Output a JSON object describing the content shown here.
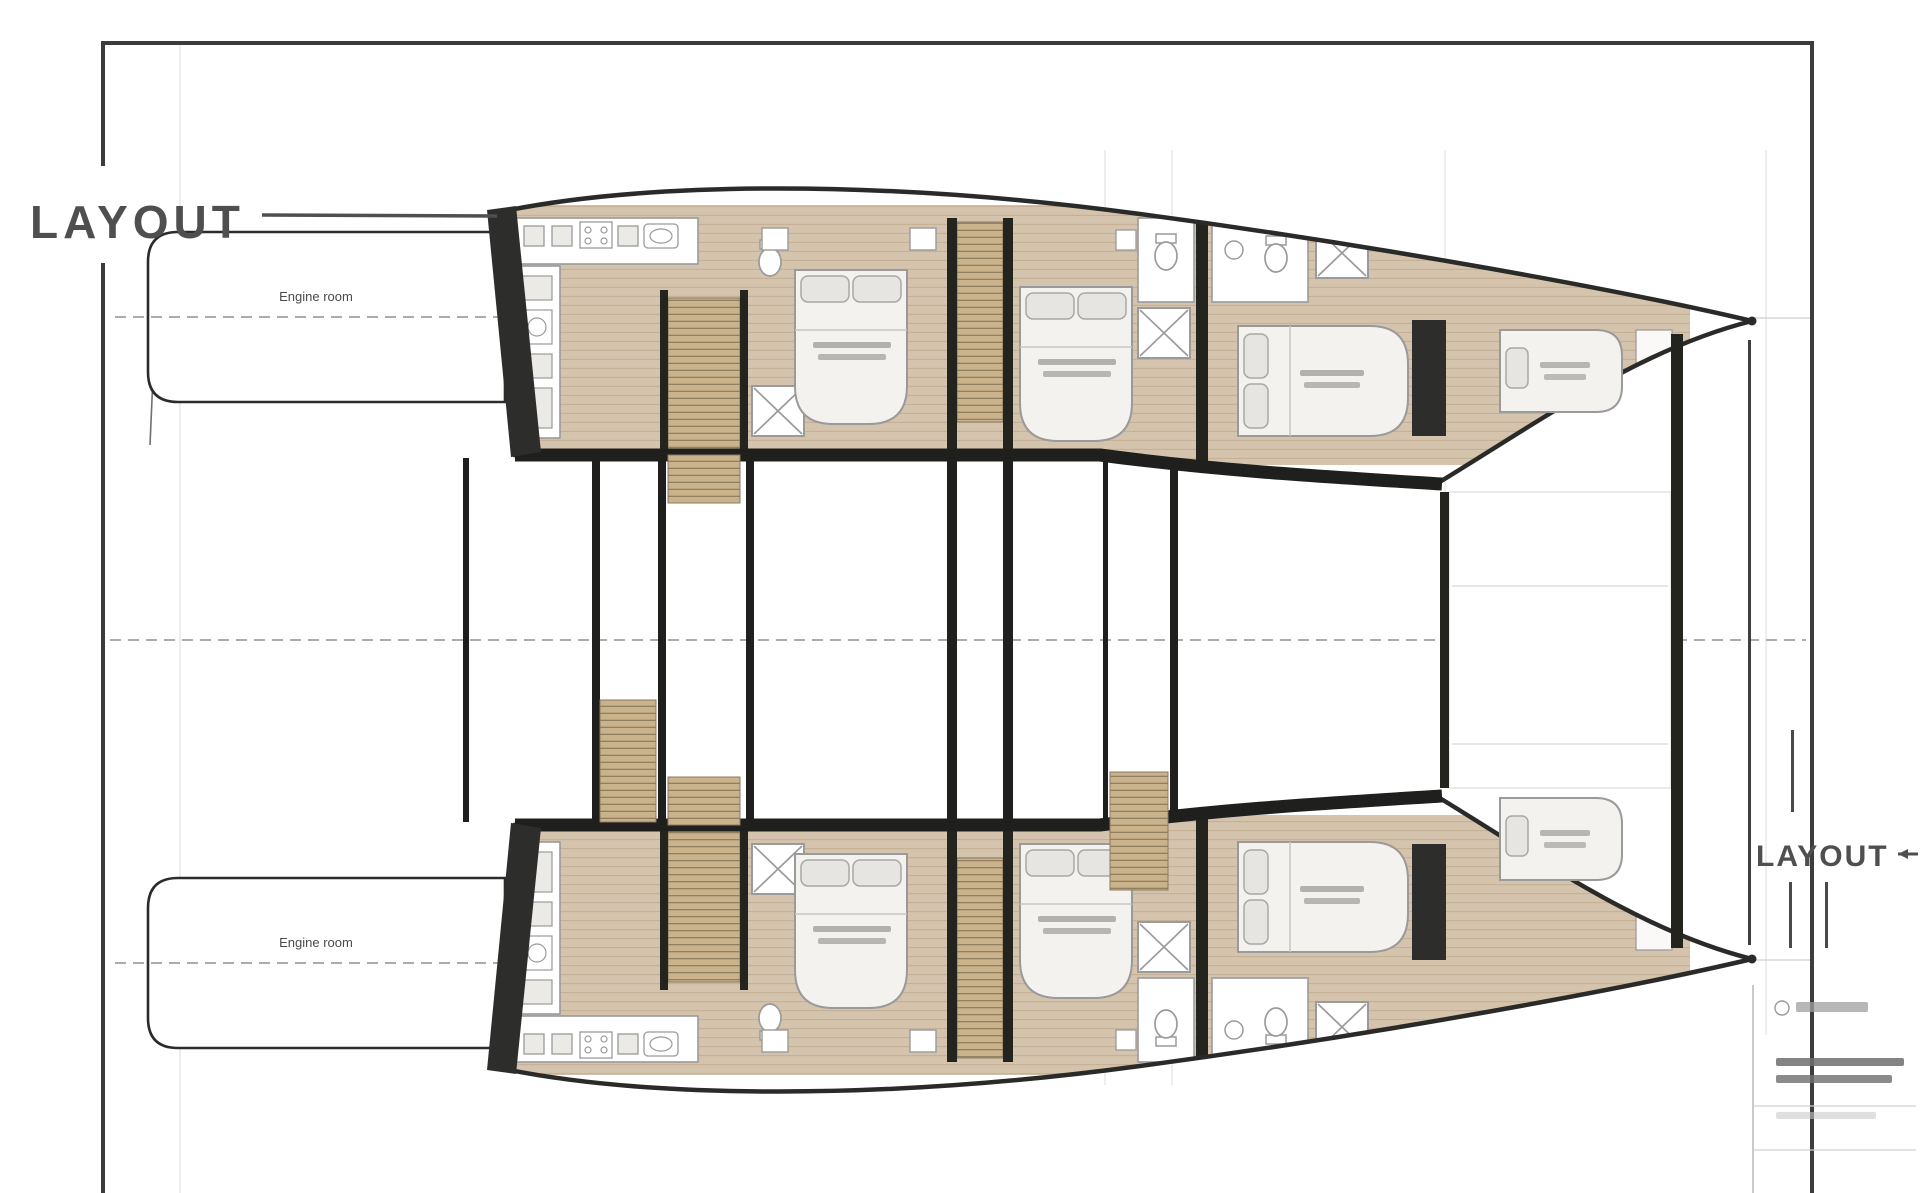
{
  "sheet": {
    "title_left": "LAYOUT",
    "title_right": "LAYOUT"
  },
  "plan": {
    "engine_room_top_label": "Engine room",
    "engine_room_bottom_label": "Engine room",
    "hulls": [
      "port hull",
      "starboard hull"
    ],
    "rooms_per_hull": [
      "galley / aft area",
      "double cabin",
      "double cabin",
      "forward double cabin",
      "bow compartment"
    ],
    "features": [
      "staircases",
      "shower boxes",
      "toilets",
      "double beds",
      "engine rooms"
    ]
  },
  "colors": {
    "frame": "#3c3c3c",
    "walls": "#24241f",
    "hull_outline": "#2a2a28",
    "wood_floor": "#d5c4ad",
    "stair_tread": "#c9b28c",
    "title_gray": "#4f4f4f",
    "centerline_gray": "#8f8f8f",
    "fixture_gray": "#9a9a9a"
  }
}
